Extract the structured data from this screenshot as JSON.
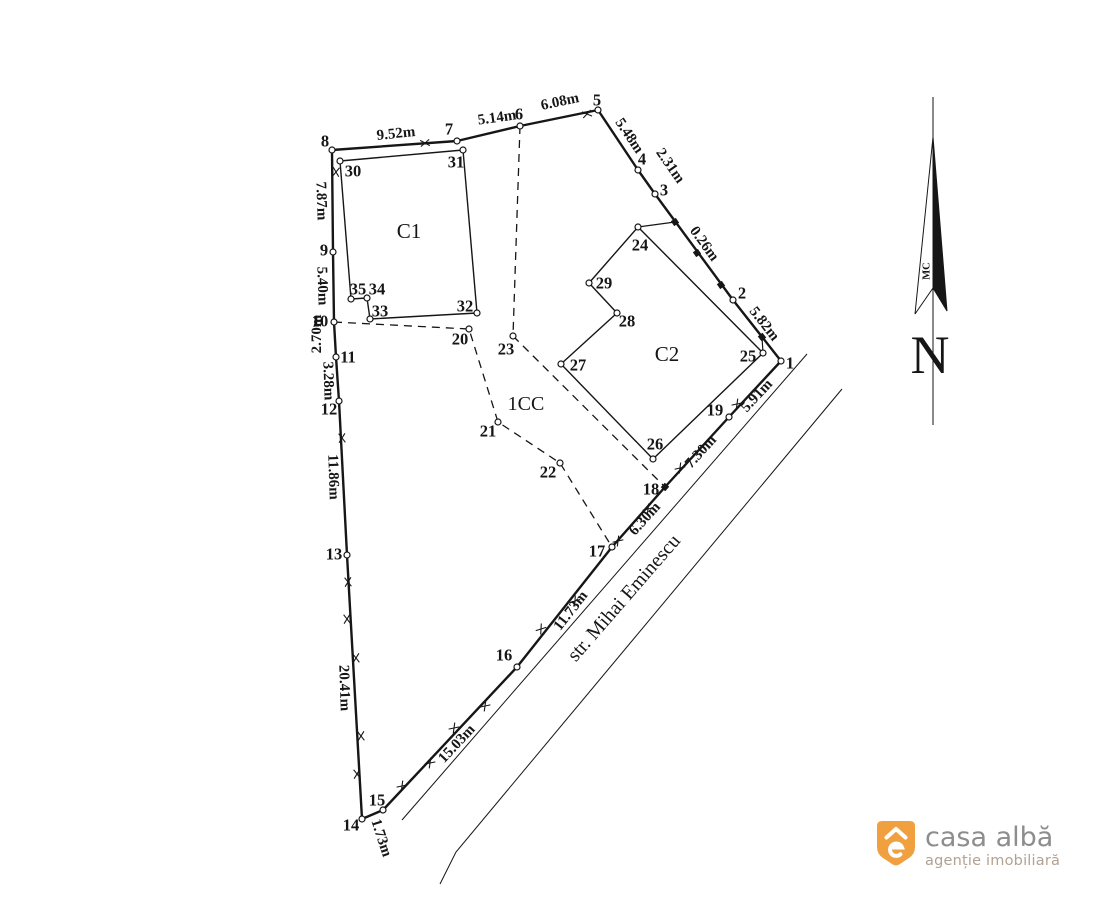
{
  "canvas": {
    "width": 1115,
    "height": 903,
    "background": "#ffffff"
  },
  "plan": {
    "stroke": "#161616",
    "points": {
      "1": [
        781,
        361,
        790,
        363
      ],
      "2": [
        733,
        300,
        742,
        293
      ],
      "3": [
        655,
        194,
        664,
        190
      ],
      "4": [
        638,
        170,
        642,
        159
      ],
      "5": [
        598,
        110,
        597,
        100
      ],
      "6": [
        520,
        126,
        519,
        114
      ],
      "7": [
        457,
        141,
        449,
        129
      ],
      "8": [
        332,
        150,
        325,
        141
      ],
      "9": [
        333,
        252,
        324,
        250
      ],
      "10": [
        334,
        322,
        320,
        321
      ],
      "11": [
        336,
        357,
        348,
        357
      ],
      "12": [
        339,
        401,
        329,
        409
      ],
      "13": [
        347,
        555,
        334,
        554
      ],
      "14": [
        362,
        819,
        351,
        825
      ],
      "15": [
        383,
        810,
        377,
        800
      ],
      "16": [
        517,
        667,
        504,
        655
      ],
      "17": [
        612,
        547,
        597,
        551
      ],
      "18": [
        665,
        487,
        651,
        489
      ],
      "19": [
        729,
        417,
        715,
        410
      ],
      "20": [
        469,
        329,
        460,
        339
      ],
      "21": [
        498,
        422,
        488,
        431
      ],
      "22": [
        560,
        463,
        548,
        472
      ],
      "23": [
        513,
        336,
        506,
        349
      ],
      "24": [
        638,
        227,
        640,
        245
      ],
      "25": [
        763,
        353,
        748,
        356
      ],
      "26": [
        653,
        459,
        655,
        444
      ],
      "27": [
        561,
        364,
        578,
        365
      ],
      "28": [
        617,
        313,
        627,
        321
      ],
      "29": [
        589,
        283,
        604,
        283
      ],
      "30": [
        340,
        161,
        353,
        171
      ],
      "31": [
        463,
        150,
        456,
        162
      ],
      "32": [
        477,
        313,
        465,
        306
      ],
      "33": [
        370,
        319,
        380,
        311
      ],
      "34": [
        367,
        298,
        377,
        289
      ],
      "35": [
        351,
        299,
        358,
        289
      ]
    },
    "boundary": [
      "1",
      "2",
      "3",
      "4",
      "5",
      "6",
      "7",
      "8",
      "9",
      "10",
      "11",
      "12",
      "13",
      "14",
      "15",
      "16",
      "17",
      "18",
      "19"
    ],
    "square_points": [
      "18"
    ],
    "buildings": [
      {
        "name": "C1",
        "corners": [
          "30",
          "31",
          "32",
          "33",
          "34",
          "35"
        ],
        "label": "C1",
        "label_x": 409,
        "label_y": 231
      },
      {
        "name": "C2",
        "corners": [
          "24",
          "25",
          "26",
          "27",
          "28",
          "29"
        ],
        "label": "C2",
        "label_x": 667,
        "label_y": 354
      }
    ],
    "zone_label": {
      "text": "1CC",
      "x": 526,
      "y": 404
    },
    "dashed_paths": [
      [
        "6",
        "23"
      ],
      [
        "23",
        "18"
      ],
      [
        "10",
        "20",
        "21",
        "22",
        "17"
      ]
    ],
    "tie_lines": [
      [
        638,
        227,
        675,
        222
      ],
      [
        763,
        353,
        762,
        337
      ]
    ],
    "street_lines": [
      [
        [
          807,
          354
        ],
        [
          402,
          820
        ]
      ],
      [
        [
          842,
          389
        ],
        [
          456,
          852
        ],
        [
          440,
          884
        ]
      ]
    ],
    "street": {
      "name": "str. Mihai Eminescu",
      "x": 624,
      "y": 598,
      "angle": -49
    },
    "measurements": [
      [
        "9.52m",
        396,
        134,
        -6
      ],
      [
        "5.14m",
        497,
        118,
        -8
      ],
      [
        "6.08m",
        560,
        102,
        -12
      ],
      [
        "5.48m",
        629,
        136,
        56
      ],
      [
        "2.31m",
        670,
        166,
        55
      ],
      [
        "0.26m",
        704,
        244,
        54
      ],
      [
        "5.82m",
        764,
        324,
        52
      ],
      [
        "5.91m",
        757,
        396,
        -47
      ],
      [
        "7.30m",
        701,
        452,
        -48
      ],
      [
        "6.30m",
        645,
        519,
        -48
      ],
      [
        "11.73m",
        571,
        611,
        -52
      ],
      [
        "15.03m",
        457,
        744,
        -47
      ],
      [
        "1.73m",
        381,
        838,
        72
      ],
      [
        "20.41m",
        344,
        688,
        88
      ],
      [
        "11.86m",
        333,
        477,
        88
      ],
      [
        "3.28m",
        328,
        381,
        88
      ],
      [
        "2.70m",
        317,
        334,
        -90
      ],
      [
        "5.40m",
        322,
        286,
        88
      ],
      [
        "7.87m",
        321,
        201,
        88
      ]
    ],
    "ticks": [
      [
        425,
        143,
        -6
      ],
      [
        587,
        114,
        -12
      ],
      [
        336,
        172,
        95
      ],
      [
        342,
        438,
        87
      ],
      [
        348,
        582,
        87
      ],
      [
        347,
        619,
        87
      ],
      [
        356,
        658,
        87
      ],
      [
        361,
        736,
        87
      ],
      [
        357,
        774,
        87
      ],
      [
        402,
        786,
        -47
      ],
      [
        430,
        763,
        -47
      ],
      [
        454,
        728,
        -47
      ],
      [
        485,
        706,
        -47
      ],
      [
        541,
        629,
        -52
      ],
      [
        575,
        601,
        -52
      ],
      [
        618,
        541,
        -48
      ],
      [
        648,
        509,
        -48
      ],
      [
        680,
        468,
        -48
      ],
      [
        737,
        404,
        -47
      ]
    ],
    "squares": [
      [
        675,
        222,
        56
      ],
      [
        697,
        253,
        56
      ],
      [
        721,
        285,
        56
      ],
      [
        762,
        337,
        51
      ]
    ]
  },
  "north_arrow": {
    "letter": "N",
    "letter_x": 930,
    "letter_y": 373,
    "small_label": "MC",
    "small_x": 927,
    "small_y": 271,
    "line_x": 933,
    "line_y1": 97,
    "line_y2": 425,
    "needle_filled": "933,137 947,311 933,288",
    "needle_open": "933,137 915,314 933,288"
  },
  "logo": {
    "title": "casa albă",
    "subtitle": "agenție imobiliară",
    "icon_color": "#f0a03e",
    "title_color": "#8d8d8d",
    "subtitle_color": "#b2a191"
  }
}
